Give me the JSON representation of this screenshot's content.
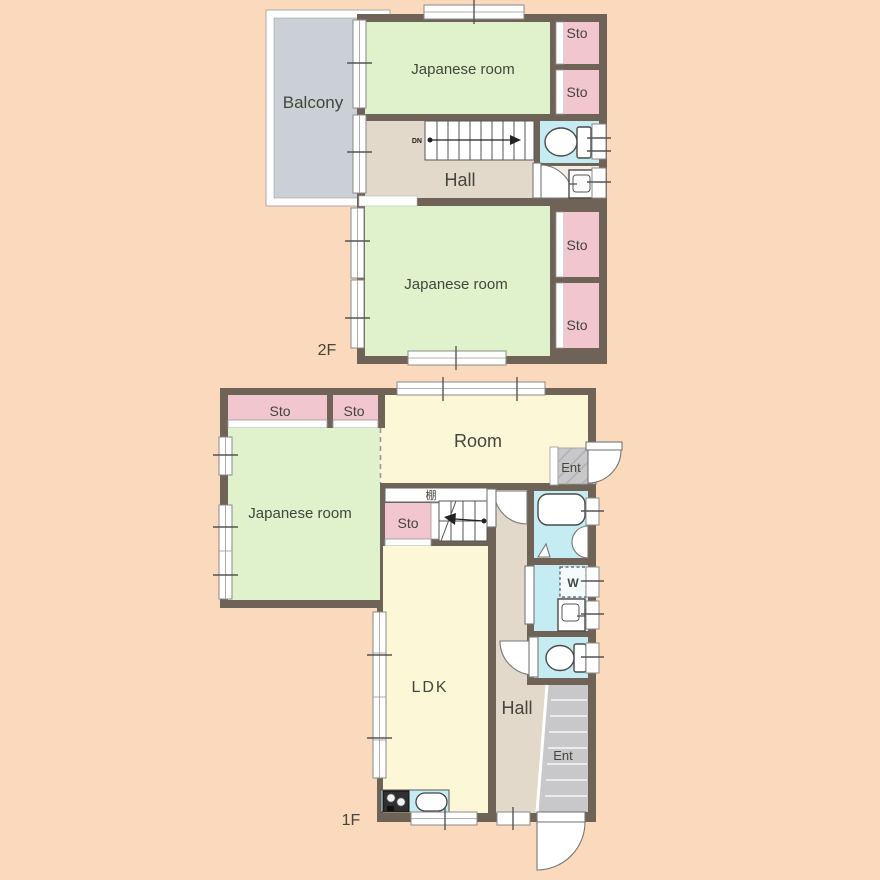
{
  "palette": {
    "wall": "#6F6357",
    "tatami_green": "#DFF2CB",
    "storage_pink": "#F2C6CE",
    "hall_beige": "#E2D9CA",
    "room_yellow": "#FCF8D7",
    "wet_cyan": "#C5ECF2",
    "balcony_gray": "#CBD0D6",
    "entrance_gray": "#C8C8CA",
    "text": "#43463C",
    "background": "#FBD9BC"
  },
  "floor_2f": {
    "name": "2F",
    "balcony": "Balcony",
    "japanese_room": "Japanese room",
    "hall": "Hall",
    "storage": "Sto",
    "stairs_down": "DN"
  },
  "floor_1f": {
    "name": "1F",
    "japanese_room": "Japanese room",
    "western_room": "Room",
    "ldk": "LDK",
    "hall": "Hall",
    "entrance": "Ent",
    "storage": "Sto",
    "shelf": "棚",
    "washing_machine": "W",
    "stairs_up": "UP"
  }
}
